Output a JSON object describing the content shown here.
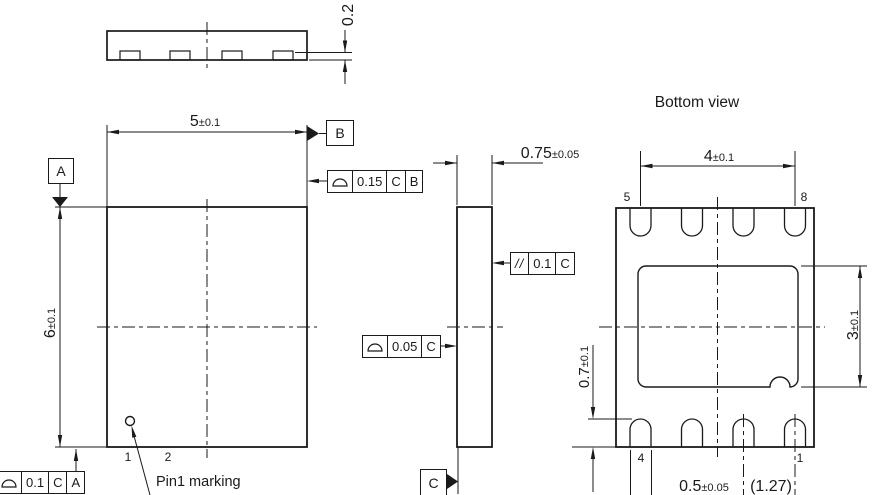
{
  "drawing": {
    "type": "mechanical package outline drawing (DFN-8)",
    "line_color": "#1a1a1a",
    "background": "#ffffff"
  },
  "top_view": {
    "standoff_dim": {
      "value": "0.2"
    }
  },
  "front_view": {
    "width_dim": {
      "value": "5",
      "tol": "±0.1"
    },
    "height_dim": {
      "value": "6",
      "tol": "±0.1"
    },
    "datum_a": "A",
    "datum_b": "B",
    "fcf_top_edge": {
      "symbol": "profile-of-a-surface",
      "value": "0.15",
      "datum1": "C",
      "datum2": "B"
    },
    "fcf_bottom_edge": {
      "symbol": "profile-of-a-surface",
      "value": "0.1",
      "datum1": "C",
      "datum2": "A"
    },
    "pin1_label": "1",
    "pin2_label": "2",
    "pin1_marking_label": "Pin1 marking"
  },
  "side_view": {
    "thickness_dim": {
      "value": "0.75",
      "tol": "±0.05"
    },
    "fcf_parallelism": {
      "symbol": "//",
      "value": "0.1",
      "datum1": "C"
    },
    "fcf_surface": {
      "symbol": "profile-of-a-surface",
      "value": "0.05",
      "datum1": "C"
    },
    "datum_c": "C"
  },
  "bottom_view": {
    "title": "Bottom view",
    "pin_span_dim": {
      "value": "4",
      "tol": "±0.1"
    },
    "pad_height_dim": {
      "value": "3",
      "tol": "±0.1"
    },
    "pin_length_dim": {
      "value": "0.7",
      "tol": "±0.1"
    },
    "pin_width_dim": {
      "value": "0.5",
      "tol": "±0.05"
    },
    "pitch_dim": {
      "value": "(1.27)"
    },
    "pin5_label": "5",
    "pin8_label": "8",
    "pin4_label": "4",
    "pin1_label": "1"
  }
}
